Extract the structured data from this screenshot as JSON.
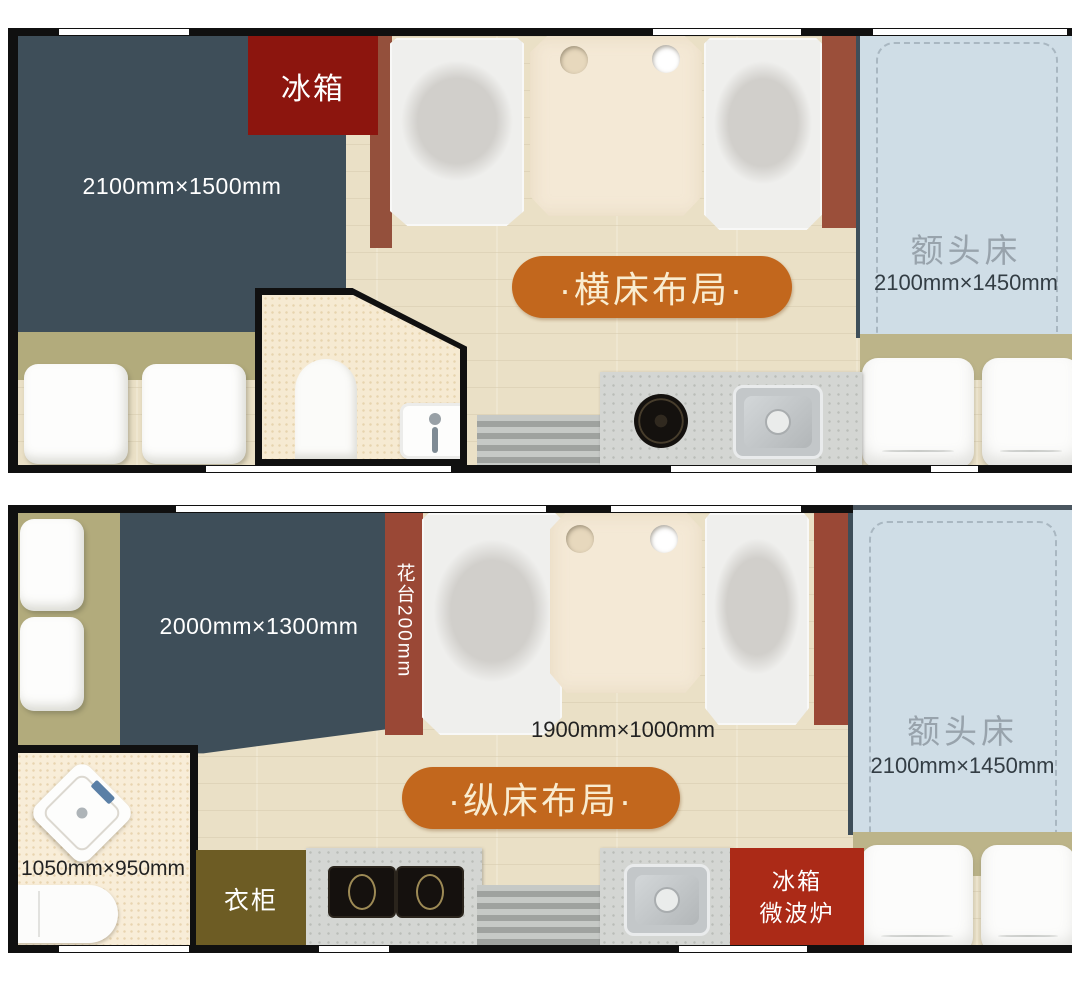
{
  "plans": [
    {
      "id": "horizontal-bed-layout",
      "badge": "·横床布局·",
      "rear_bed_dim": "2100mm×1500mm",
      "fridge_label": "冰箱",
      "cab_bed_label": "额头床",
      "cab_bed_dim": "2100mm×1450mm"
    },
    {
      "id": "longitudinal-bed-layout",
      "badge": "·纵床布局·",
      "rear_bed_dim": "2000mm×1300mm",
      "flower_stand_label": "花台200mm",
      "side_bed_dim": "1900mm×1000mm",
      "bathroom_dim": "1050mm×950mm",
      "wardrobe_label": "衣柜",
      "fridge_label": "冰箱",
      "microwave_label": "微波炉",
      "cab_bed_label": "额头床",
      "cab_bed_dim": "2100mm×1450mm"
    }
  ],
  "colors": {
    "bed_dark_blue": "#3e4e59",
    "cab_bed_blue": "#cfdde6",
    "badge_orange": "#c2671d",
    "fridge_dark_red": "#8c150e",
    "fridge_microwave_red": "#ab2a17",
    "wardrobe_olive": "#6d5c24",
    "seat_base_olive": "#b2ab7c",
    "accent_strip_red": "#9a4836",
    "floor_wood": "#eae0c6"
  }
}
